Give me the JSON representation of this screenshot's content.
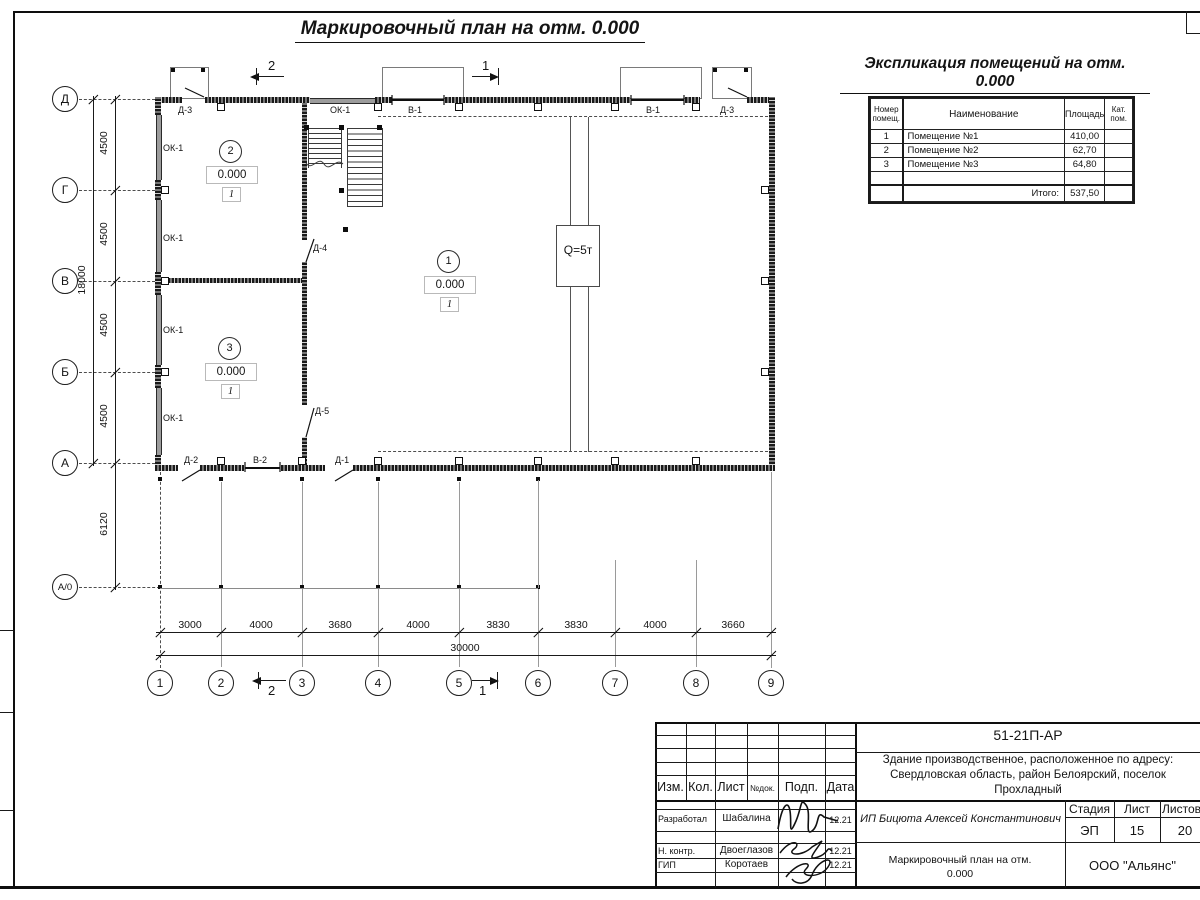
{
  "plan": {
    "title": "Маркировочный план на отм. 0.000",
    "crane": "Q=5т",
    "rooms": [
      {
        "num": "1",
        "elevation": "0.000",
        "category": "1"
      },
      {
        "num": "2",
        "elevation": "0.000",
        "category": "1"
      },
      {
        "num": "3",
        "elevation": "0.000",
        "category": "1"
      }
    ],
    "labels": {
      "ok1": "ОК-1",
      "v1": "В-1",
      "v2": "В-2",
      "d1": "Д-1",
      "d2": "Д-2",
      "d3": "Д-3",
      "d4": "Д-4",
      "d5": "Д-5"
    },
    "sections": {
      "s1": "1",
      "s2": "2"
    }
  },
  "grid": {
    "rows": [
      "Д",
      "Г",
      "В",
      "Б",
      "А",
      "А/0"
    ],
    "cols": [
      "1",
      "2",
      "3",
      "4",
      "5",
      "6",
      "7",
      "8",
      "9"
    ],
    "row_dims": [
      "4500",
      "4500",
      "4500",
      "4500"
    ],
    "row_below": "6120",
    "row_total": "18000",
    "col_dims": [
      "3000",
      "4000",
      "3680",
      "4000",
      "3830",
      "3830",
      "4000",
      "3660"
    ],
    "col_total": "30000"
  },
  "explication": {
    "title": "Экспликация помещений на отм. 0.000",
    "headers": {
      "num": "Номер помещ.",
      "name": "Наименование",
      "area": "Площадь",
      "cat": "Кат. пом."
    },
    "rows": [
      {
        "num": "1",
        "name": "Помещение №1",
        "area": "410,00"
      },
      {
        "num": "2",
        "name": "Помещение №2",
        "area": "62,70"
      },
      {
        "num": "3",
        "name": "Помещение №3",
        "area": "64,80"
      }
    ],
    "total_label": "Итого:",
    "total_value": "537,50"
  },
  "title_block": {
    "doc_number": "51-21П-АР",
    "project": "Здание производственное, расположенное по адресу: Свердловская область, район Белоярский, поселок Прохладный",
    "client": "ИП Бицюта Алексей Константинович",
    "columns": [
      "Изм.",
      "Кол.",
      "Лист",
      "№док.",
      "Подп.",
      "Дата"
    ],
    "signers": [
      {
        "role": "Разработал",
        "name": "Шабалина",
        "date": "12.21"
      },
      {
        "role": "Н. контр.",
        "name": "Двоеглазов",
        "date": "12.21"
      },
      {
        "role": "ГИП",
        "name": "Коротаев",
        "date": "12.21"
      }
    ],
    "stage_label": "Стадия",
    "stage": "ЭП",
    "sheet_label": "Лист",
    "sheet": "15",
    "sheets_label": "Листов",
    "sheets": "20",
    "drawing_title": "Маркировочный план на отм. 0.000",
    "company": "ООО \"Альянс\""
  }
}
